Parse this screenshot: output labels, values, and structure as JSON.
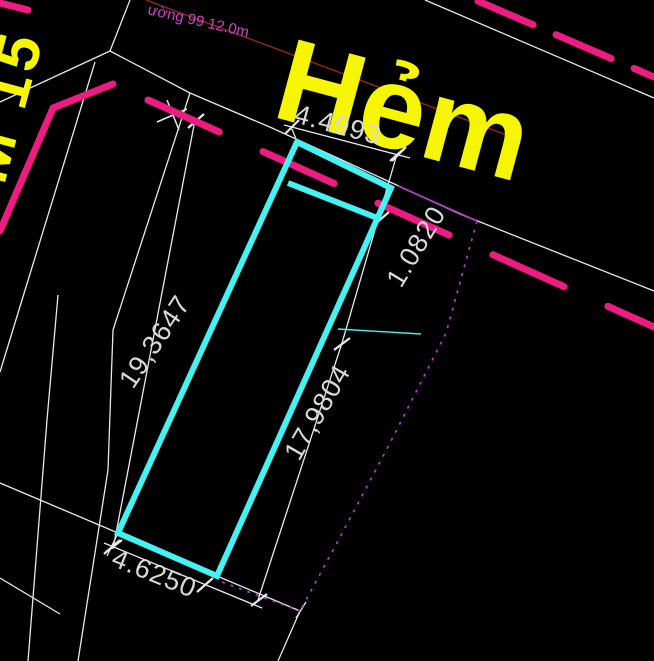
{
  "drawing": {
    "title_hint": "cadastral plot drawing",
    "street_label_large": "Hẻm",
    "street_label_side": "M 15",
    "road_note": "ường 99 12.0m",
    "dimensions": {
      "front_width": "4.4993",
      "setback_offset": "1.0820",
      "left_side": "19,3647",
      "right_side": "17,9804",
      "rear_width": "4.6250"
    },
    "colors": {
      "background": "#000000",
      "plot_outline_cyan": "#45f1f1",
      "road_dash_magenta": "#ee1b80",
      "boundary_purple": "#b43ccd",
      "label_yellow": "#f6f600",
      "dimension_text": "#d9d9d9",
      "boundary_white": "#e9e9e9",
      "road_note_magenta": "#cc44cc",
      "thin_red_line": "#8d2418"
    }
  }
}
